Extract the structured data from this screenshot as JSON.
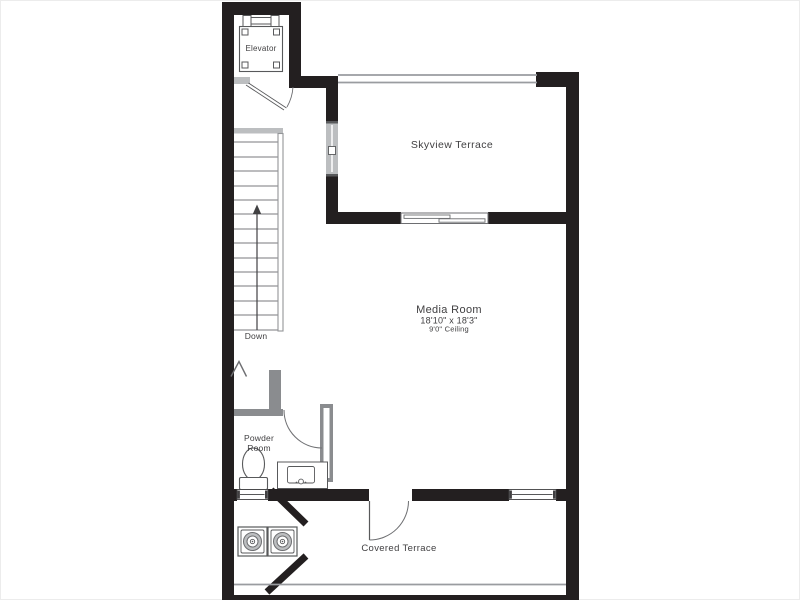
{
  "floor_plan": {
    "rooms": {
      "elevator": {
        "label": "Elevator"
      },
      "skyview_terrace": {
        "label": "Skyview Terrace"
      },
      "media_room": {
        "label": "Media Room",
        "dimensions": "18'10\" x 18'3\"",
        "ceiling": "9'0\" Ceiling"
      },
      "powder_room": {
        "label_line1": "Powder",
        "label_line2": "Room"
      },
      "covered_terrace": {
        "label": "Covered Terrace"
      }
    },
    "stairs": {
      "direction_label": "Down"
    },
    "colors": {
      "exterior_wall": "#231f20",
      "interior_wall": "#8a8c8f",
      "fixture_line": "#58595b",
      "threshold_gray": "#bcbec0",
      "railing_gray": "#9a9ca0",
      "text": "#414042",
      "background": "#ffffff"
    }
  }
}
